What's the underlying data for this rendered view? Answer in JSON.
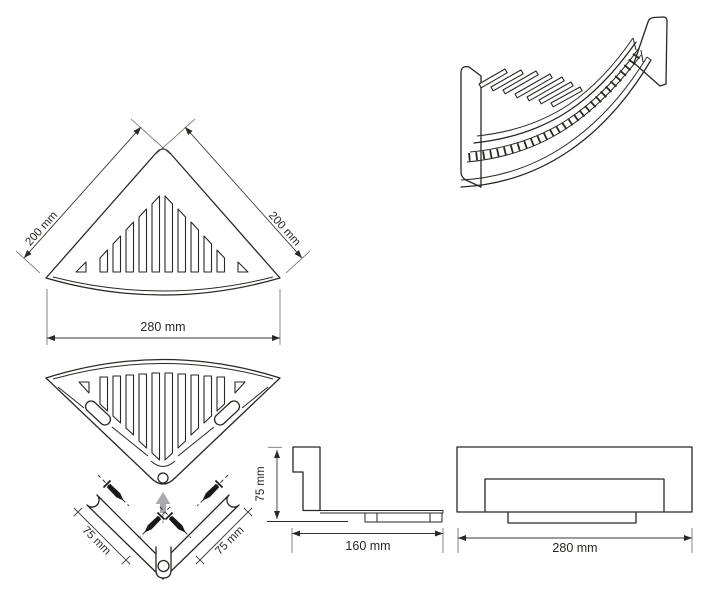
{
  "dimensions": {
    "top_view_left_edge": "200 mm",
    "top_view_right_edge": "200 mm",
    "overall_width": "280 mm",
    "bracket_arm_left": "75 mm",
    "bracket_arm_right": "75 mm",
    "side_height": "75 mm",
    "side_depth": "160 mm",
    "front_width": "280 mm"
  },
  "colors": {
    "background": "#ffffff",
    "line": "#2b2724",
    "gray_arrow": "#a7a9ac",
    "screw": "#1b1917"
  }
}
